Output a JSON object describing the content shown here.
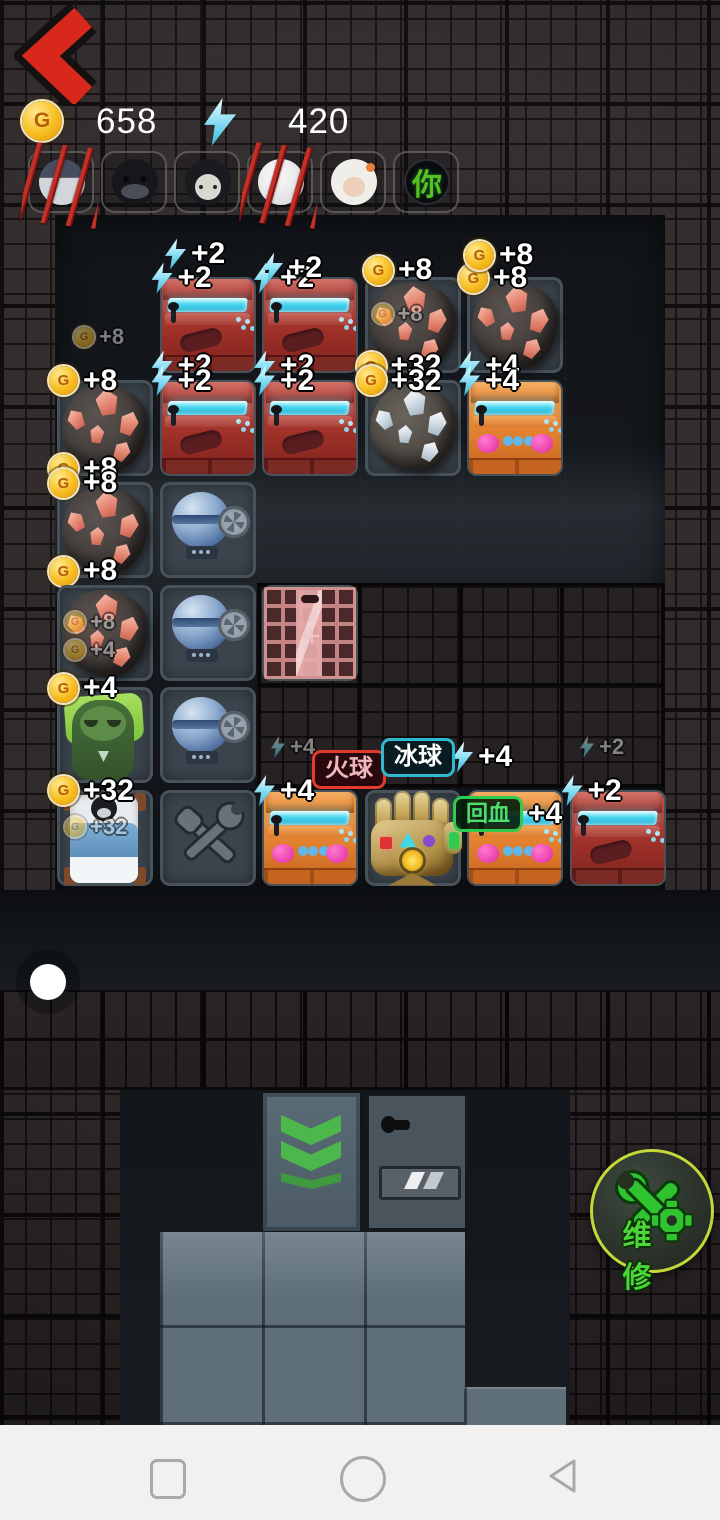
{
  "header": {
    "coins": "658",
    "energy": "420",
    "coin_letter": "G"
  },
  "tags": {
    "fireball": "火球",
    "iceball": "冰球",
    "heal": "回血",
    "repair": "维修"
  },
  "avatars": [
    {
      "id": "char-1",
      "style": "gray",
      "clawed": true
    },
    {
      "id": "char-2",
      "style": "ape",
      "clawed": false
    },
    {
      "id": "char-3",
      "style": "girl",
      "clawed": false
    },
    {
      "id": "char-4",
      "style": "white",
      "clawed": true
    },
    {
      "id": "char-5",
      "style": "granny",
      "clawed": false
    },
    {
      "id": "char-6",
      "style": "ghost",
      "clawed": false,
      "overlay_text": "你"
    }
  ],
  "grid": {
    "items": [
      {
        "type": "red-arcade",
        "col": 1,
        "row": 0,
        "badges": [
          {
            "pos": "top",
            "icon": "bolt",
            "value": "+2"
          },
          {
            "pos": "bottom",
            "icon": "bolt",
            "value": "+2"
          }
        ]
      },
      {
        "type": "red-arcade",
        "col": 2,
        "row": 0,
        "badges": [
          {
            "pos": "top",
            "icon": "bolt",
            "value": "+2"
          },
          {
            "pos": "bottom",
            "icon": "bolt",
            "value": "+2"
          }
        ]
      },
      {
        "type": "ore-red",
        "col": 3,
        "row": 0,
        "badges": [
          {
            "pos": "mid",
            "icon": "coin",
            "value": "+8",
            "faded": true
          },
          {
            "pos": "bottom",
            "icon": "coin",
            "value": "+32"
          }
        ]
      },
      {
        "type": "ore-red",
        "col": 4,
        "row": 0,
        "badges": [
          {
            "pos": "top",
            "icon": "coin",
            "value": "+8"
          },
          {
            "pos": "bottom",
            "icon": "bolt",
            "value": "+4"
          }
        ]
      },
      {
        "type": "ore-red",
        "col": 0,
        "row": 1,
        "badges": [
          {
            "pos": "top",
            "icon": "coin",
            "value": "+8"
          },
          {
            "pos": "bottom",
            "icon": "coin",
            "value": "+8"
          }
        ]
      },
      {
        "type": "red-arcade",
        "col": 1,
        "row": 1,
        "badges": [
          {
            "pos": "top",
            "icon": "bolt",
            "value": "+2"
          }
        ]
      },
      {
        "type": "red-arcade",
        "col": 2,
        "row": 1,
        "badges": [
          {
            "pos": "top",
            "icon": "bolt",
            "value": "+2"
          }
        ]
      },
      {
        "type": "ore-silver",
        "col": 3,
        "row": 1,
        "badges": [
          {
            "pos": "top",
            "icon": "coin",
            "value": "+32"
          }
        ]
      },
      {
        "type": "orange-arcade",
        "col": 4,
        "row": 1,
        "badges": [
          {
            "pos": "top",
            "icon": "bolt",
            "value": "+4"
          }
        ]
      },
      {
        "type": "ore-red",
        "col": 0,
        "row": 2,
        "badges": [
          {
            "pos": "top",
            "icon": "coin",
            "value": "+8"
          },
          {
            "pos": "bottom",
            "icon": "coin",
            "value": "+8"
          }
        ]
      },
      {
        "type": "washer",
        "col": 1,
        "row": 2,
        "badges": []
      },
      {
        "type": "ore-red",
        "col": 0,
        "row": 3,
        "badges": [
          {
            "pos": "mid",
            "icon": "coin",
            "value": "+8",
            "faded": true
          },
          {
            "pos": "mid2",
            "icon": "coin",
            "value": "+4",
            "faded": true
          }
        ]
      },
      {
        "type": "washer",
        "col": 1,
        "row": 3,
        "badges": []
      },
      {
        "type": "door",
        "col": 2,
        "row": 3,
        "badges": []
      },
      {
        "type": "zombie",
        "col": 0,
        "row": 4,
        "badges": [
          {
            "pos": "top",
            "icon": "coin",
            "value": "+4"
          }
        ]
      },
      {
        "type": "washer",
        "col": 1,
        "row": 4,
        "badges": []
      },
      {
        "type": "bed",
        "col": 0,
        "row": 5,
        "badges": [
          {
            "pos": "top",
            "icon": "coin",
            "value": "+32"
          },
          {
            "pos": "mid",
            "icon": "coin",
            "value": "+32",
            "faded": true
          }
        ]
      },
      {
        "type": "tools",
        "col": 1,
        "row": 5,
        "badges": []
      },
      {
        "type": "orange-arcade",
        "col": 2,
        "row": 5,
        "badges": [
          {
            "pos": "top",
            "icon": "bolt",
            "value": "+4"
          }
        ]
      },
      {
        "type": "gauntlet",
        "col": 3,
        "row": 5,
        "badges": []
      },
      {
        "type": "orange-arcade",
        "col": 4,
        "row": 5,
        "badges": [
          {
            "pos": "top-tag",
            "tag": "heal",
            "icon": "none",
            "value": "+4"
          }
        ]
      },
      {
        "type": "red-arcade",
        "col": 5,
        "row": 5,
        "badges": [
          {
            "pos": "top",
            "icon": "bolt",
            "value": "+2"
          }
        ]
      }
    ]
  },
  "floats": [
    {
      "x": 165,
      "y": 237,
      "icon": "bolt",
      "value": "+2"
    },
    {
      "x": 262,
      "y": 251,
      "icon": "bolt",
      "value": "+2"
    },
    {
      "x": 364,
      "y": 253,
      "icon": "coin",
      "value": "+8"
    },
    {
      "x": 465,
      "y": 238,
      "icon": "coin",
      "value": "+8"
    },
    {
      "x": 74,
      "y": 324,
      "icon": "coin",
      "value": "+8",
      "faded": true
    },
    {
      "x": 271,
      "y": 734,
      "icon": "bolt",
      "value": "+4",
      "faded": true
    },
    {
      "x": 452,
      "y": 740,
      "icon": "bolt",
      "value": "+4"
    },
    {
      "x": 580,
      "y": 734,
      "icon": "bolt",
      "value": "+2",
      "faded": true
    }
  ]
}
